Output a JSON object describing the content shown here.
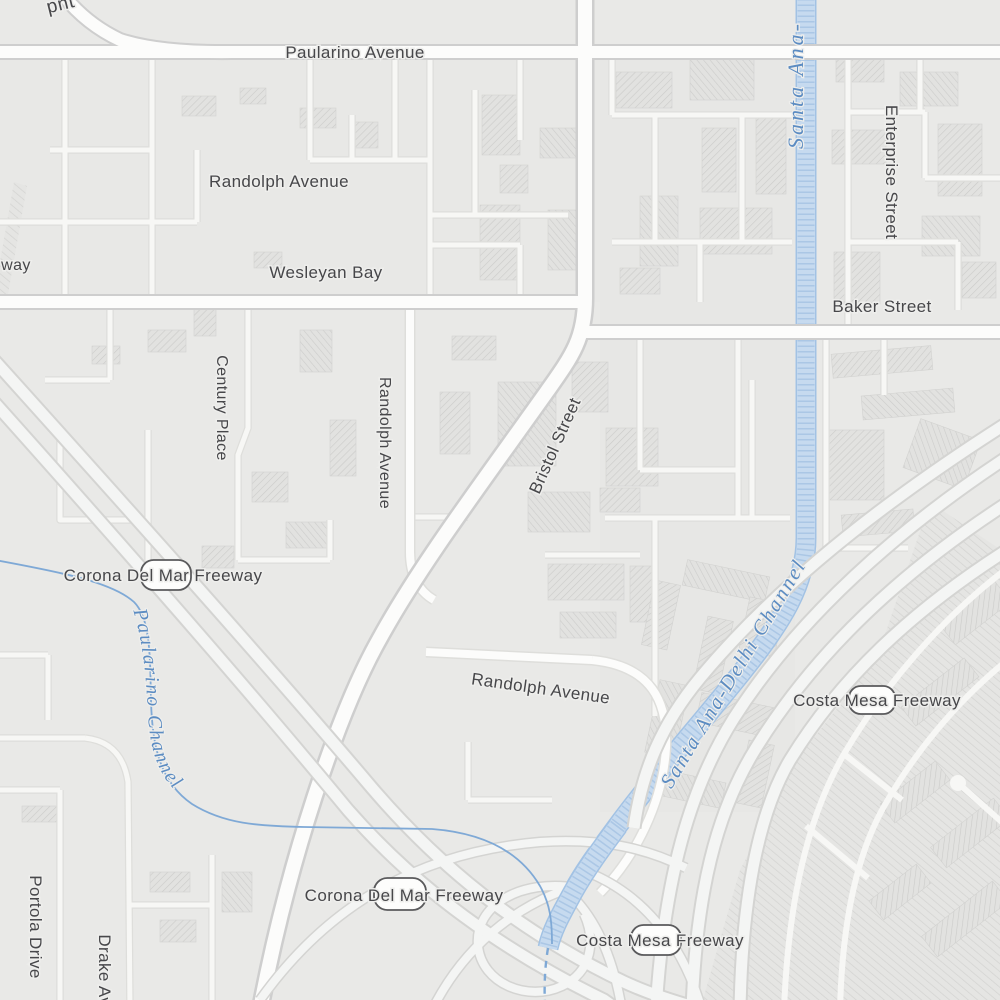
{
  "map": {
    "palette": {
      "bg": "#e9e9e7",
      "minor_fill": "#f7f7f5",
      "minor_casing": "#dededb",
      "road_fill": "#fcfcfb",
      "road_casing": "#cecece",
      "fwy_fill": "#f4f5f4",
      "fwy_casing": "#d4d4d2",
      "water_fill": "#c6daef",
      "water_edge": "#a2c2e4",
      "water_texture": "#8fb4db",
      "stream": "#7fa9d6",
      "street_label": "#47474a",
      "water_label": "#5c8cc2",
      "halo": "#eeeeec",
      "shield_fill": "#fdfdfc",
      "shield_stroke": "#5a5a5c",
      "bld_edge": "#d2d2d0"
    },
    "shields": [
      {
        "cx": 166,
        "cy": 575,
        "w": 50,
        "h": 30
      },
      {
        "cx": 400,
        "cy": 894,
        "w": 52,
        "h": 32
      },
      {
        "cx": 872,
        "cy": 700,
        "w": 46,
        "h": 28
      },
      {
        "cx": 656,
        "cy": 940,
        "w": 50,
        "h": 30
      }
    ],
    "labels": [
      {
        "name": "paularino-avenue",
        "text": "Paularino Avenue",
        "x": 355,
        "y": 58,
        "r": 0,
        "s": 17,
        "ls": 0.4,
        "cls": "street"
      },
      {
        "name": "randolph-avenue-upper",
        "text": "Randolph Avenue",
        "x": 279,
        "y": 187,
        "r": 0,
        "s": 17,
        "ls": 0.4,
        "cls": "street"
      },
      {
        "name": "wesleyan-bay",
        "text": "Wesleyan Bay",
        "x": 326,
        "y": 278,
        "r": 0,
        "s": 17,
        "ls": 0.4,
        "cls": "street"
      },
      {
        "name": "baker-street",
        "text": "Baker Street",
        "x": 882,
        "y": 312,
        "r": 0,
        "s": 17,
        "ls": 0.4,
        "cls": "street"
      },
      {
        "name": "enterprise-street",
        "text": "Enterprise Street",
        "x": 886,
        "y": 172,
        "r": 90,
        "s": 17,
        "ls": 0.4,
        "cls": "street"
      },
      {
        "name": "century-place",
        "text": "Century Place",
        "x": 217,
        "y": 408,
        "r": 90,
        "s": 16,
        "ls": 0.4,
        "cls": "street"
      },
      {
        "name": "randolph-avenue-vertical",
        "text": "Randolph Avenue",
        "x": 380,
        "y": 443,
        "r": 90,
        "s": 16,
        "ls": 0.4,
        "cls": "street"
      },
      {
        "name": "bristol-street",
        "text": "Bristol Street",
        "x": 560,
        "y": 448,
        "r": -66,
        "s": 17,
        "ls": 0.4,
        "cls": "street"
      },
      {
        "name": "randolph-avenue-lower",
        "text": "Randolph Avenue",
        "x": 540,
        "y": 694,
        "r": 8,
        "s": 17,
        "ls": 0.4,
        "cls": "street"
      },
      {
        "name": "corona-del-mar-freeway-upper",
        "text": "Corona Del Mar Freeway",
        "x": 163,
        "y": 581,
        "r": 0,
        "s": 17,
        "ls": 0.4,
        "cls": "street"
      },
      {
        "name": "corona-del-mar-freeway-lower",
        "text": "Corona Del Mar Freeway",
        "x": 404,
        "y": 901,
        "r": 0,
        "s": 17,
        "ls": 0.4,
        "cls": "street"
      },
      {
        "name": "costa-mesa-freeway-east",
        "text": "Costa Mesa Freeway",
        "x": 877,
        "y": 706,
        "r": 0,
        "s": 17,
        "ls": 0.4,
        "cls": "street"
      },
      {
        "name": "costa-mesa-freeway-south",
        "text": "Costa Mesa Freeway",
        "x": 660,
        "y": 946,
        "r": 0,
        "s": 17,
        "ls": 0.4,
        "cls": "street"
      },
      {
        "name": "portola-drive",
        "text": "Portola Drive",
        "x": 30,
        "y": 927,
        "r": 90,
        "s": 17,
        "ls": 0.4,
        "cls": "street"
      },
      {
        "name": "drake-avenue",
        "text": "Drake Avenue",
        "x": 99,
        "y": 990,
        "r": 90,
        "s": 17,
        "ls": 0.4,
        "cls": "street"
      },
      {
        "name": "way-partial",
        "text": "way",
        "x": 16,
        "y": 270,
        "r": 0,
        "s": 16,
        "ls": 0.4,
        "cls": "street"
      },
      {
        "name": "pnt-partial",
        "text": "pnt",
        "x": 62,
        "y": 10,
        "r": -14,
        "s": 19,
        "ls": 0.6,
        "cls": "street"
      },
      {
        "name": "santa-ana-partial",
        "text": "Santa Ana-",
        "x": 803,
        "y": 85,
        "r": -90,
        "s": 22,
        "ls": 3,
        "cls": "water"
      },
      {
        "name": "santa-ana-delhi-channel",
        "text": "Santa Ana-Delhi Channel",
        "x": 739,
        "y": 677,
        "r": -59,
        "s": 21,
        "ls": 2,
        "cls": "water"
      },
      {
        "name": "paularino-channel",
        "text": "Paularino Channel",
        "pathId": "pch-label",
        "off": "2%",
        "s": 20,
        "ls": 2,
        "cls": "water"
      }
    ]
  }
}
